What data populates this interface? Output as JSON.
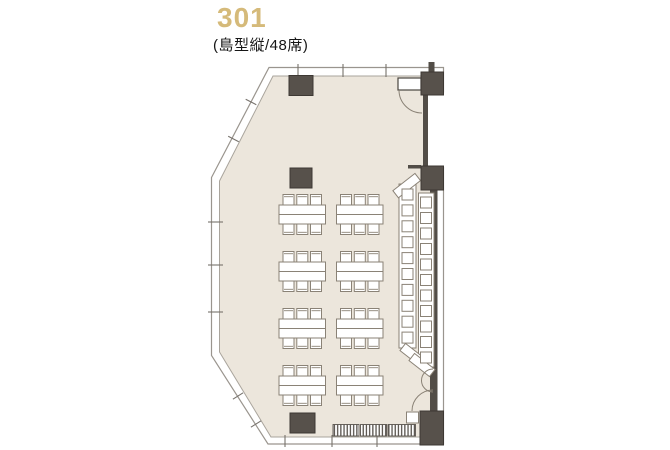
{
  "header": {
    "room_number": "301",
    "layout_label": "(島型縦/48席)"
  },
  "colors": {
    "accent_gold": "#d5ba7a",
    "floor_fill": "#ece6dc",
    "wall_line": "#9a958e",
    "fixture_dark": "#57514b",
    "furniture_line": "#8a8276"
  },
  "floorplan": {
    "tables": {
      "rows": 4,
      "cols": 2,
      "chairs_per_table": 6,
      "total_seats": 48
    },
    "side_chair_columns": [
      {
        "position": "inner-row",
        "count": 10
      },
      {
        "position": "wall-row",
        "count": 11
      }
    ],
    "stacked_chair_groups": 3,
    "pillars": 6,
    "doors": 2
  }
}
